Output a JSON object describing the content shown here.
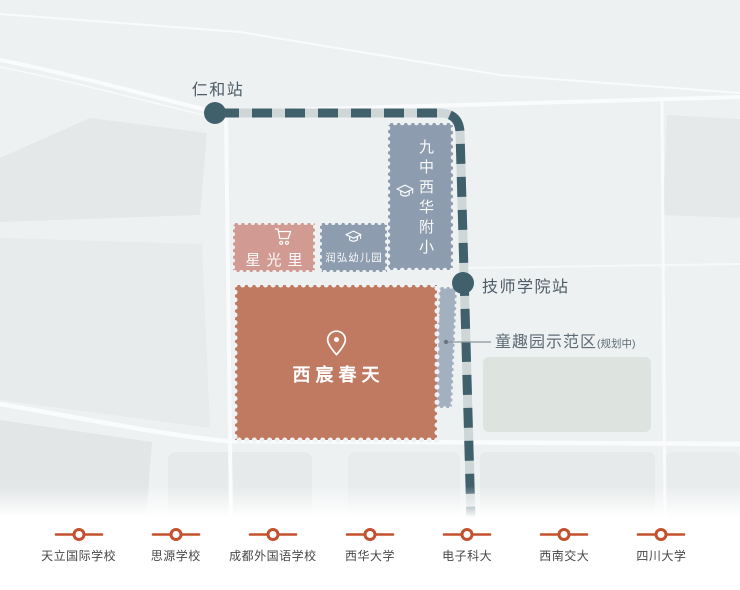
{
  "map": {
    "stations": [
      {
        "label": "仁和站"
      },
      {
        "label": "技师学院站"
      }
    ],
    "blocks": [
      {
        "id": "school",
        "label": "九中西华附小",
        "icon": "graduation-cap-icon"
      },
      {
        "id": "xingguangli",
        "label": "星光里",
        "icon": "shopping-cart-icon"
      },
      {
        "id": "kindergarten",
        "label": "润弘幼儿园",
        "icon": "graduation-cap-icon"
      },
      {
        "id": "project",
        "label": "西宸春天",
        "icon": "location-pin-icon"
      }
    ],
    "callout": {
      "label": "童趣园示范区",
      "suffix": "(规划中)"
    },
    "colors": {
      "background": "#eef1f2",
      "project_block": "#c07a61",
      "school_block": "#8d9cae",
      "retail_block": "#d19b94",
      "planned_strip": "#9cabbc",
      "metro_dash": "#40606c",
      "metro_track": "#cfd6d8",
      "legend_accent": "#c3512f"
    }
  },
  "legend": {
    "items": [
      {
        "label": "天立国际学校"
      },
      {
        "label": "思源学校"
      },
      {
        "label": "成都外国语学校"
      },
      {
        "label": "西华大学"
      },
      {
        "label": "电子科大"
      },
      {
        "label": "西南交大"
      },
      {
        "label": "四川大学"
      }
    ]
  }
}
